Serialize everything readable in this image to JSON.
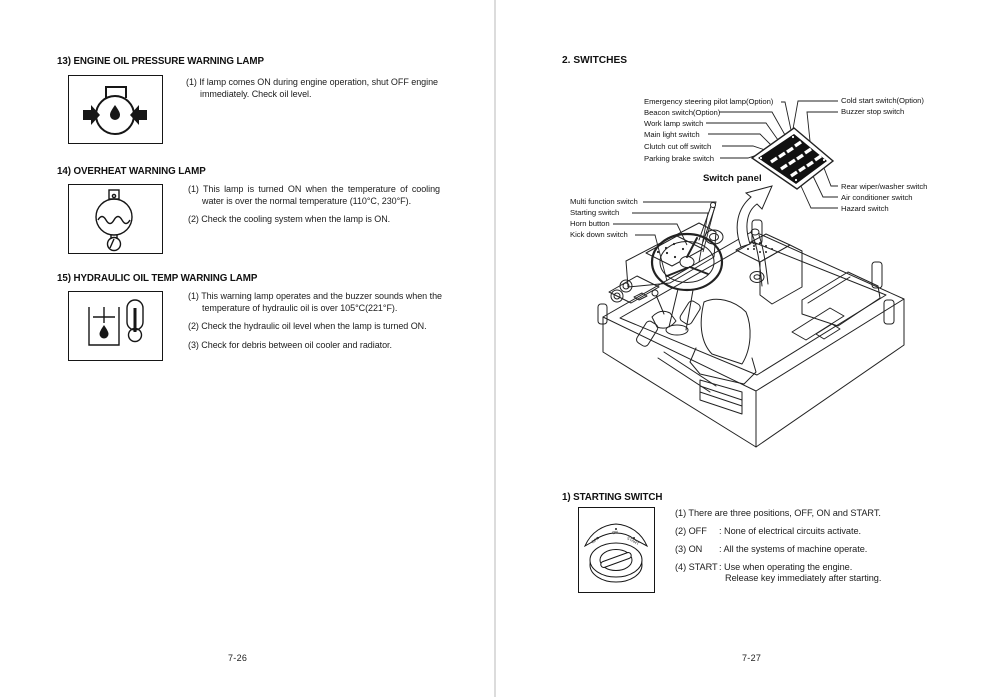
{
  "colors": {
    "ink": "#1c1c1c",
    "line": "#222222",
    "panel_fill": "#111111",
    "divider": "#dcdcdc",
    "paper": "#ffffff"
  },
  "icons": {
    "engine_oil_pressure": "oil-can-with-inward-arrows",
    "overheat": "coolant-temperature-bulb",
    "hydraulic_oil_temp": "oil-tank-with-thermometer",
    "starting_switch": "key-switch-cylinder",
    "panel_arrow": "curved-callout-arrow"
  },
  "left_page": {
    "page_number": "7-26",
    "sections": [
      {
        "title": "13) ENGINE OIL PRESSURE WARNING LAMP",
        "items": [
          "(1) If lamp comes ON during engine operation, shut OFF engine immediately.  Check oil level."
        ]
      },
      {
        "title": "14) OVERHEAT WARNING LAMP",
        "items": [
          "(1) This lamp is turned ON when the temperature of cooling water is over the normal temperature (110°C, 230°F).",
          "(2) Check the cooling system when the lamp is ON."
        ]
      },
      {
        "title": "15) HYDRAULIC OIL TEMP WARNING LAMP",
        "items": [
          "(1) This warning lamp operates and the buzzer sounds when the temperature of hydraulic oil is over 105°C(221°F).",
          "(2) Check the hydraulic oil level when the lamp is turned ON.",
          "(3) Check for debris between oil cooler and radiator."
        ]
      }
    ]
  },
  "right_page": {
    "page_number": "7-27",
    "header": "2. SWITCHES",
    "switch_panel": {
      "caption": "Switch panel",
      "labels_left": [
        "Emergency steering pilot lamp(Option)",
        "Beacon switch(Option)",
        "Work lamp switch",
        "Main light switch",
        "Clutch cut off switch",
        "Parking brake switch"
      ],
      "labels_right_top": [
        "Cold start switch(Option)",
        "Buzzer stop switch"
      ],
      "labels_right_bottom": [
        "Rear wiper/washer switch",
        "Air conditioner switch",
        "Hazard switch"
      ]
    },
    "cab_labels": [
      "Multi function switch",
      "Starting switch",
      "Horn button",
      "Kick down switch"
    ],
    "starting_switch": {
      "title": "1) STARTING SWITCH",
      "key_positions": [
        "OFF",
        "ON",
        "START"
      ],
      "items": [
        {
          "text": "(1) There are three positions, OFF, ON and START."
        },
        {
          "label": "(2) OFF",
          "desc": ": None of electrical circuits activate."
        },
        {
          "label": "(3) ON",
          "desc": ": All the systems of machine operate."
        },
        {
          "label": "(4) START",
          "desc": ": Use when operating the engine.",
          "desc2": "Release key immediately after starting."
        }
      ]
    }
  }
}
